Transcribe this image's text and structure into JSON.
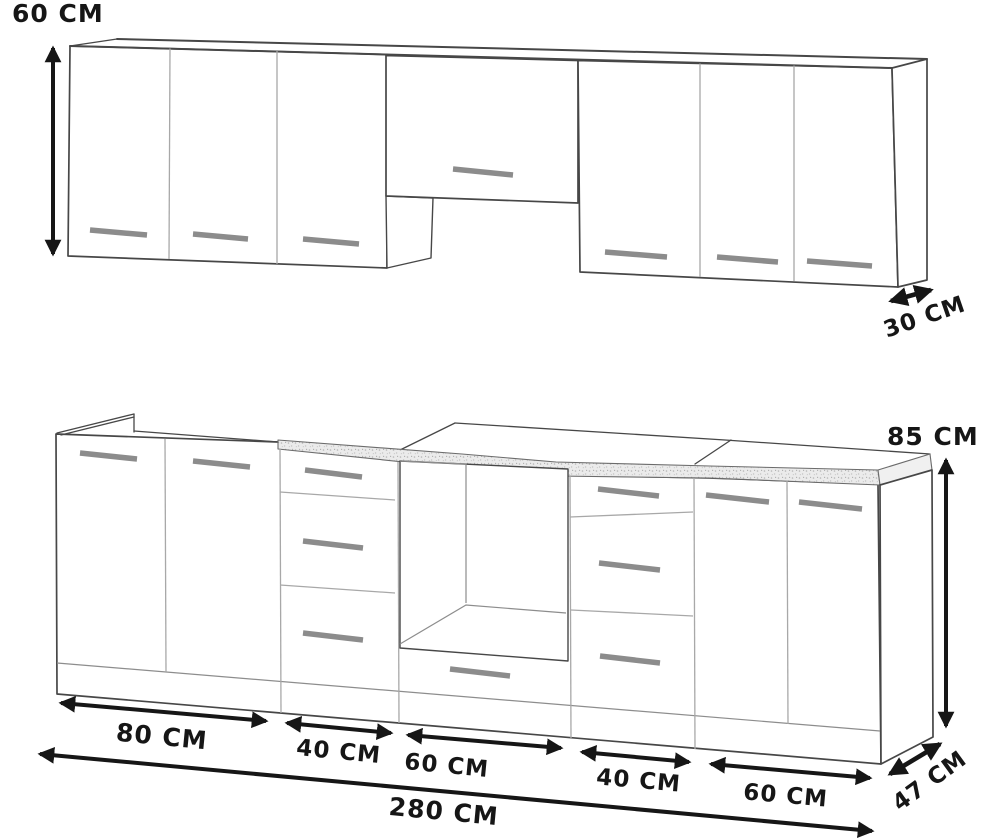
{
  "dimensions": {
    "wall_height": "60 CM",
    "wall_depth": "30 CM",
    "base_height": "85 CM",
    "base_depth": "47 CM",
    "base_widths": [
      "80 CM",
      "40 CM",
      "60 CM",
      "40 CM",
      "60 CM"
    ],
    "base_total_width": "280 CM"
  },
  "colors": {
    "ink": "#161616",
    "line_strong": "#474747",
    "line_light": "#a8a8a8",
    "handle": "#8c8c8c",
    "counter_base": "#ebebeb",
    "counter_speck": "#b5b5b5"
  }
}
